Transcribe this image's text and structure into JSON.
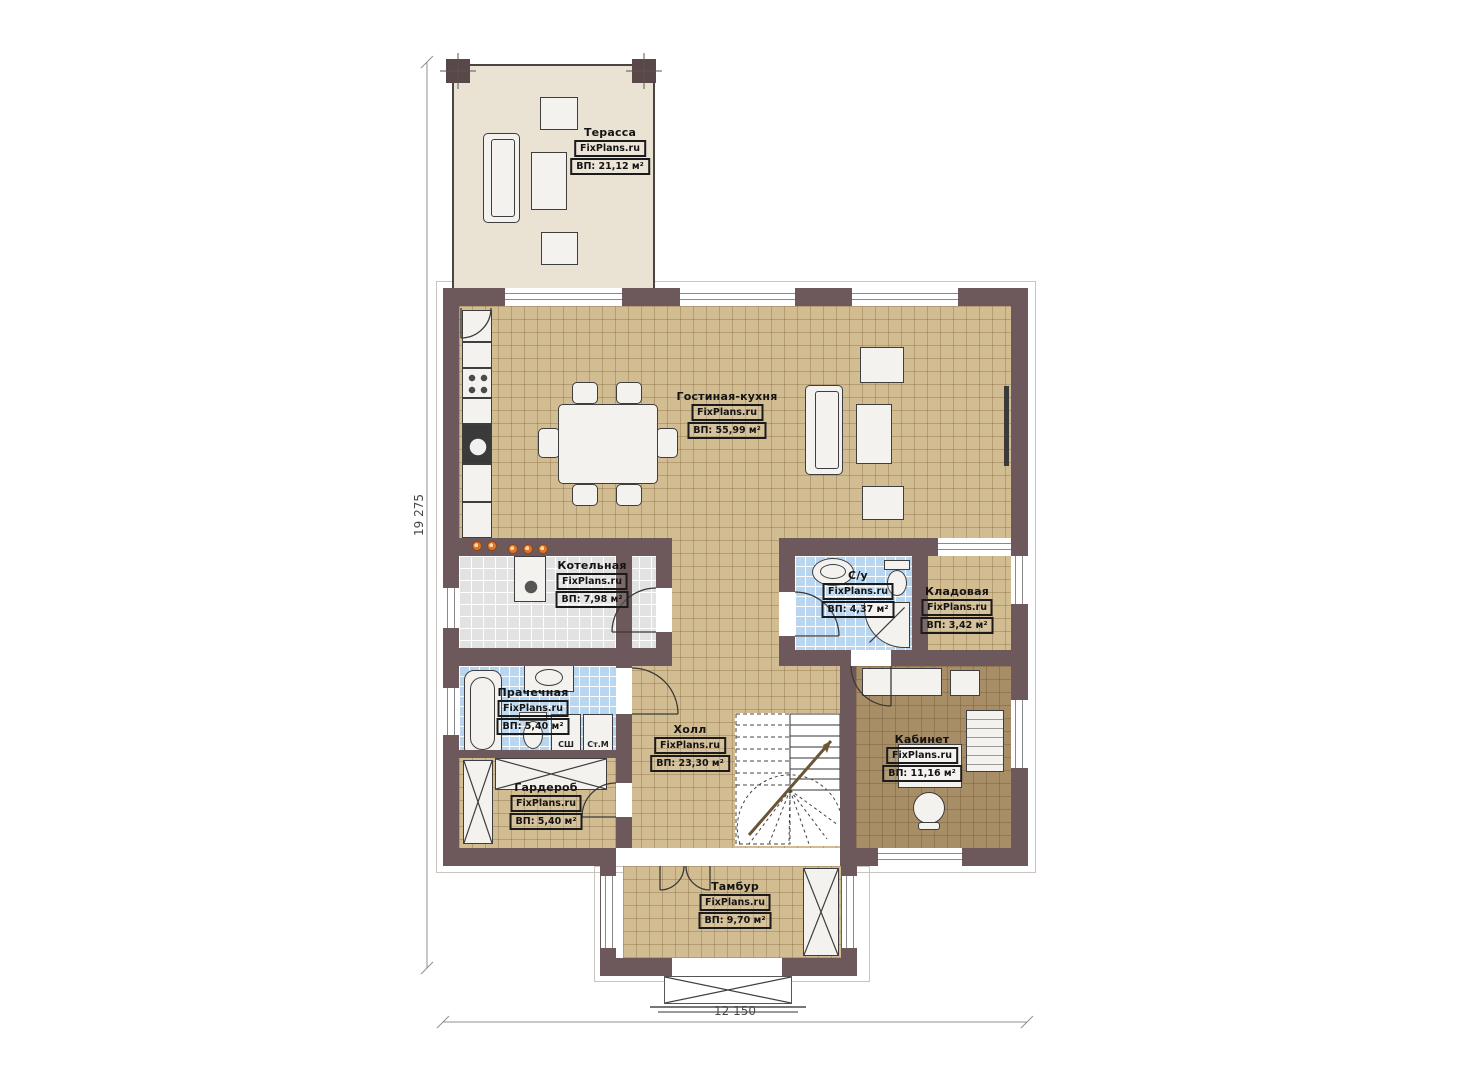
{
  "plan": {
    "watermark": "FixPlans.ru",
    "dimensions": {
      "height_label": "19 275",
      "width_label": "12 150"
    },
    "rooms": [
      {
        "name": "Терасса",
        "area": "ВП: 21,12 м²"
      },
      {
        "name": "Гостиная-кухня",
        "area": "ВП: 55,99 м²"
      },
      {
        "name": "Котельная",
        "area": "ВП: 7,98 м²"
      },
      {
        "name": "С/у",
        "area": "ВП: 4,37 м²"
      },
      {
        "name": "Кладовая",
        "area": "ВП: 3,42 м²"
      },
      {
        "name": "Прачечная",
        "area": "ВП: 5,40 м²"
      },
      {
        "name": "Холл",
        "area": "ВП: 23,30 м²"
      },
      {
        "name": "Гардероб",
        "area": "ВП: 5,40 м²"
      },
      {
        "name": "Кабинет",
        "area": "ВП: 11,16 м²"
      },
      {
        "name": "Тамбур",
        "area": "ВП: 9,70 м²"
      }
    ],
    "appliances": {
      "dryer": "СШ",
      "washer": "Ст.М"
    },
    "colors": {
      "wall": "#6d595b",
      "tan_floor": "#d2bc92",
      "blue_tile": "#b9d6f0",
      "gray_tile": "#e2e2e2",
      "office_floor": "#a88e67",
      "terrace_floor": "#eae2d3",
      "accent_dots": "#df752d"
    }
  }
}
